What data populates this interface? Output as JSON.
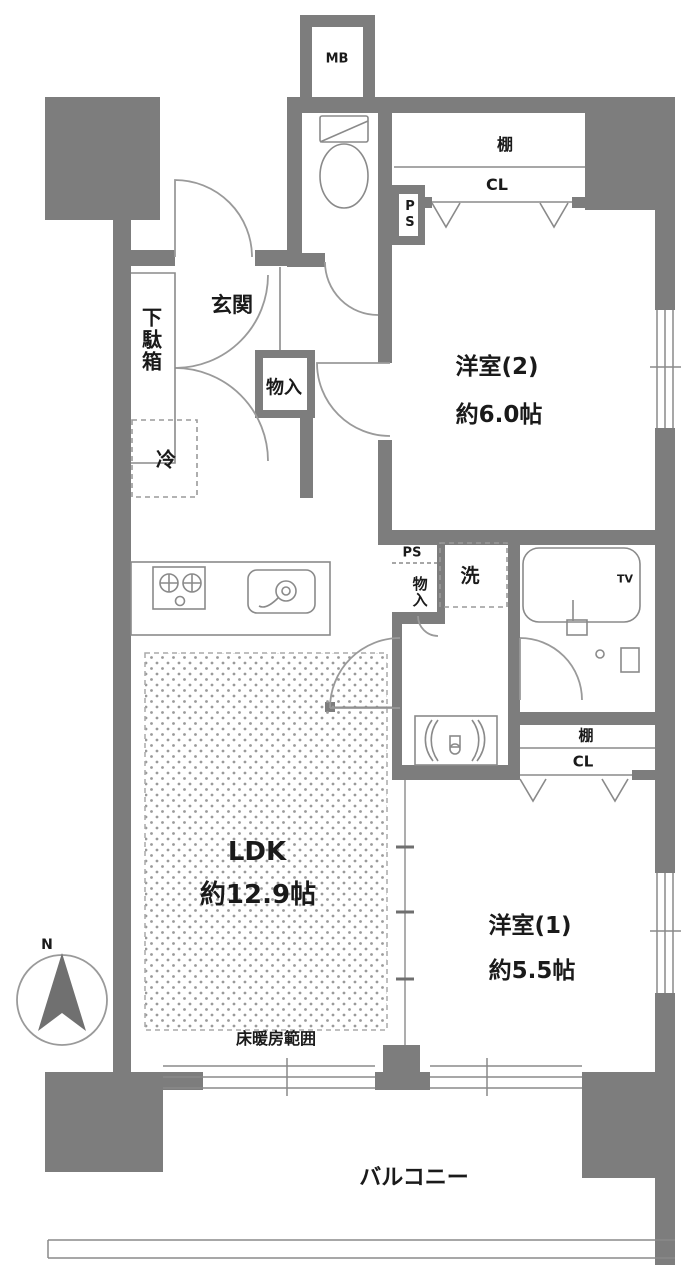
{
  "colors": {
    "wall": "#7d7d7d",
    "line": "#8a8a8a",
    "text": "#1a1a1a",
    "background": "#ffffff"
  },
  "labels": {
    "meter_box": "MB",
    "pipe_space_top": "PS",
    "shelf_top": "棚",
    "closet_top": "CL",
    "western_room_2_name": "洋室(2)",
    "western_room_2_size": "約6.0帖",
    "entrance": "玄関",
    "shoe_cabinet": "下駄箱",
    "entrance_storage": "物入",
    "refrigerator": "冷",
    "pipe_space_mid": "PS",
    "hall_storage": "物入",
    "washer": "洗",
    "bath_tv": "TV",
    "shelf_right": "棚",
    "closet_right": "CL",
    "ldk_name": "LDK",
    "ldk_size": "約12.9帖",
    "floor_heating": "床暖房範囲",
    "western_room_1_name": "洋室(1)",
    "western_room_1_size": "約5.5帖",
    "balcony": "バルコニー",
    "compass_north": "N"
  }
}
